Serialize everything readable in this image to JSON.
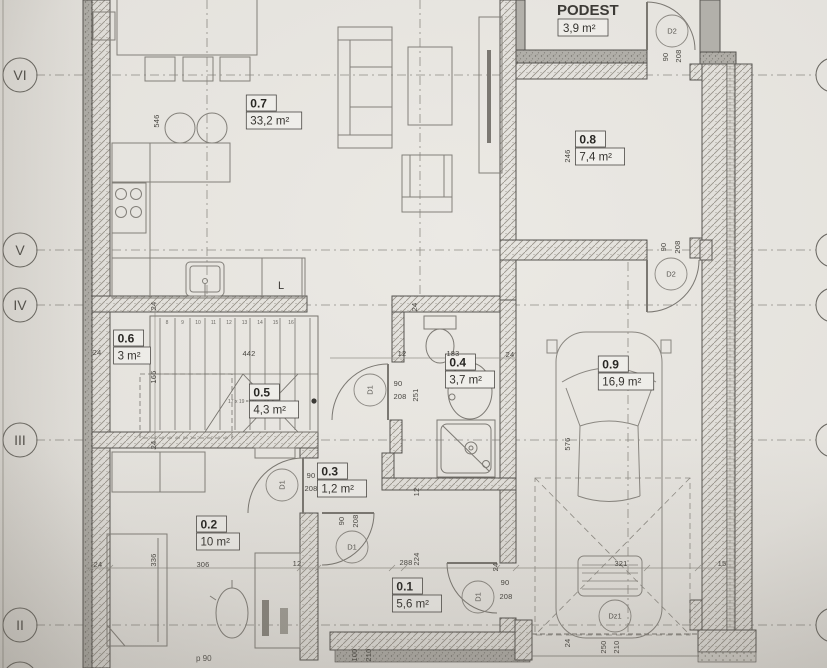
{
  "plan": {
    "podest": {
      "title": "PODEST",
      "area": "3,9 m²"
    },
    "rooms": [
      {
        "number": "0.7",
        "area": "33,2 m²",
        "cx": 274,
        "cy": 112
      },
      {
        "number": "0.8",
        "area": "7,4 m²",
        "cx": 600,
        "cy": 148
      },
      {
        "number": "0.9",
        "area": "16,9 m²",
        "cx": 626,
        "cy": 373
      },
      {
        "number": "0.6",
        "area": "3 m²",
        "cx": 132,
        "cy": 347
      },
      {
        "number": "0.5",
        "area": "4,3 m²",
        "cx": 274,
        "cy": 401
      },
      {
        "number": "0.4",
        "area": "3,7 m²",
        "cx": 470,
        "cy": 371
      },
      {
        "number": "0.3",
        "area": "1,2 m²",
        "cx": 342,
        "cy": 480
      },
      {
        "number": "0.2",
        "area": "10 m²",
        "cx": 218,
        "cy": 533
      },
      {
        "number": "0.1",
        "area": "5,6 m²",
        "cx": 417,
        "cy": 595
      }
    ],
    "doors": [
      {
        "label": "D1",
        "cx": 370,
        "cy": 390,
        "rot": 90
      },
      {
        "label": "D1",
        "cx": 282,
        "cy": 485,
        "rot": 90
      },
      {
        "label": "D1",
        "cx": 352,
        "cy": 547,
        "rot": 0
      },
      {
        "label": "D1",
        "cx": 478,
        "cy": 597,
        "rot": 90
      },
      {
        "label": "D2",
        "cx": 672,
        "cy": 31,
        "rot": 0
      },
      {
        "label": "D2",
        "cx": 671,
        "cy": 274,
        "rot": 0
      },
      {
        "label": "Dz1",
        "cx": 615,
        "cy": 616,
        "rot": 0
      }
    ],
    "grid_markers": [
      {
        "label": "VI",
        "y": 75
      },
      {
        "label": "V",
        "y": 250
      },
      {
        "label": "IV",
        "y": 305
      },
      {
        "label": "III",
        "y": 440
      },
      {
        "label": "II",
        "y": 625
      }
    ],
    "dimensions": [
      {
        "t": "90",
        "x": 398,
        "y": 386,
        "r": 0
      },
      {
        "t": "208",
        "x": 400,
        "y": 399,
        "r": 0
      },
      {
        "t": "90",
        "x": 311,
        "y": 478,
        "r": 0
      },
      {
        "t": "208",
        "x": 311,
        "y": 491,
        "r": 0
      },
      {
        "t": "90",
        "x": 344,
        "y": 521,
        "r": 90
      },
      {
        "t": "208",
        "x": 358,
        "y": 521,
        "r": 90
      },
      {
        "t": "90",
        "x": 505,
        "y": 585,
        "r": 0
      },
      {
        "t": "208",
        "x": 506,
        "y": 599,
        "r": 0
      },
      {
        "t": "90",
        "x": 668,
        "y": 57,
        "r": 90
      },
      {
        "t": "208",
        "x": 681,
        "y": 56,
        "r": 90
      },
      {
        "t": "90",
        "x": 666,
        "y": 247,
        "r": 90
      },
      {
        "t": "208",
        "x": 680,
        "y": 247,
        "r": 90
      },
      {
        "t": "246",
        "x": 570,
        "y": 156,
        "r": 90
      },
      {
        "t": "251",
        "x": 418,
        "y": 395,
        "r": 90
      },
      {
        "t": "183",
        "x": 453,
        "y": 356,
        "r": 0
      },
      {
        "t": "12",
        "x": 402,
        "y": 356,
        "r": 0
      },
      {
        "t": "24",
        "x": 510,
        "y": 357,
        "r": 0
      },
      {
        "t": "24",
        "x": 417,
        "y": 307,
        "r": 90
      },
      {
        "t": "24",
        "x": 156,
        "y": 306,
        "r": 90
      },
      {
        "t": "24",
        "x": 97,
        "y": 355,
        "r": 0
      },
      {
        "t": "442",
        "x": 249,
        "y": 356,
        "r": 0
      },
      {
        "t": "166",
        "x": 156,
        "y": 377,
        "r": 90
      },
      {
        "t": "24",
        "x": 156,
        "y": 445,
        "r": 90
      },
      {
        "t": "546",
        "x": 159,
        "y": 121,
        "r": 90
      },
      {
        "t": "336",
        "x": 156,
        "y": 560,
        "r": 90
      },
      {
        "t": "24",
        "x": 98,
        "y": 567,
        "r": 0
      },
      {
        "t": "306",
        "x": 203,
        "y": 567,
        "r": 0
      },
      {
        "t": "12",
        "x": 297,
        "y": 566,
        "r": 0
      },
      {
        "t": "288",
        "x": 406,
        "y": 565,
        "r": 0
      },
      {
        "t": "224",
        "x": 419,
        "y": 559,
        "r": 90
      },
      {
        "t": "24",
        "x": 498,
        "y": 567,
        "r": 90
      },
      {
        "t": "321",
        "x": 621,
        "y": 566,
        "r": 0
      },
      {
        "t": "15",
        "x": 722,
        "y": 566,
        "r": 0
      },
      {
        "t": "576",
        "x": 570,
        "y": 444,
        "r": 90
      },
      {
        "t": "12",
        "x": 419,
        "y": 492,
        "r": 90
      },
      {
        "t": "100",
        "x": 357,
        "y": 655,
        "r": 90
      },
      {
        "t": "210",
        "x": 371,
        "y": 655,
        "r": 90
      },
      {
        "t": "24",
        "x": 570,
        "y": 643,
        "r": 90
      },
      {
        "t": "250",
        "x": 606,
        "y": 647,
        "r": 90
      },
      {
        "t": "210",
        "x": 619,
        "y": 647,
        "r": 90
      }
    ],
    "stair_note": "17 x 19 = 29",
    "fridge_label": "L",
    "parapet_note": "p 90",
    "step_numbers": [
      "8",
      "9",
      "10",
      "11",
      "12",
      "13",
      "14",
      "15",
      "16"
    ]
  },
  "colors": {
    "paper": "#ebe9e4",
    "wall_hatch_bg": "#e7e5e0",
    "wall_dark": "#b3b1ab",
    "line": "#55534f"
  }
}
